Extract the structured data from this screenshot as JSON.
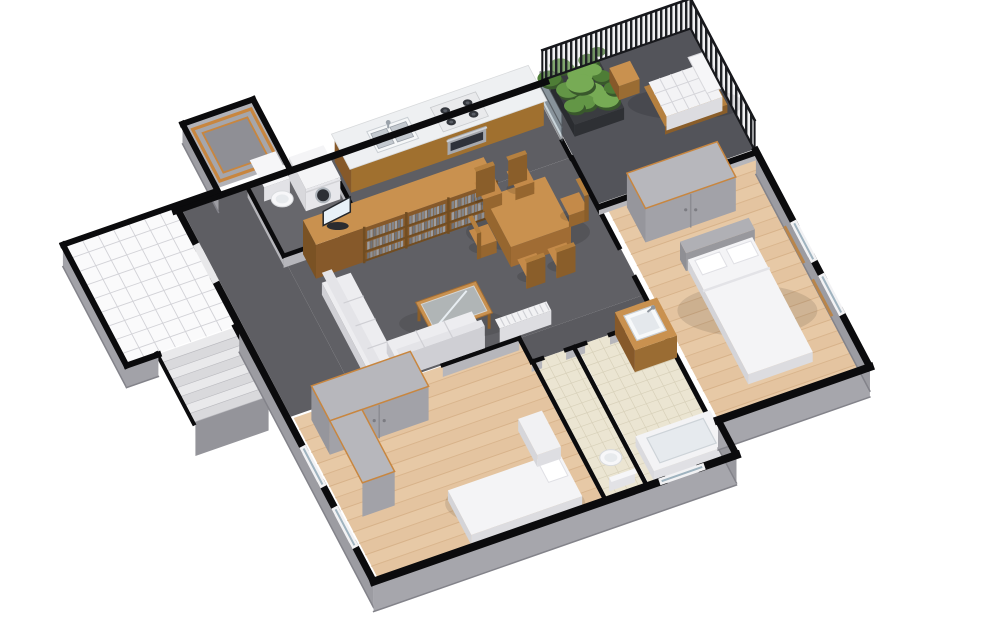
{
  "view": {
    "type": "3d-floorplan-cutaway-render",
    "background": "#ffffff",
    "width": 1000,
    "height": 644
  },
  "palette": {
    "wall_top": "#0b0b0d",
    "wall_face": "#a4a4aa",
    "wall_face_dark": "#94949a",
    "floor_dark": "#5e5e63",
    "floor_balcony": "#53545a",
    "floor_plank": "#e7c9a6",
    "plank_line": "#d3ac82",
    "tile_cream": "#ebe5d2",
    "tile_cream_line": "#d8d1ba",
    "tile_white": "#fafafb",
    "tile_white_line": "#d2d2d7",
    "wood_top": "#c9914f",
    "wood_face": "#9a6c33",
    "wood_face_dark": "#86592a",
    "accent_frame": "#c8863f",
    "white_soft": "#f4f4f6",
    "white_face": "#dcdce0",
    "glass": "#a9bac4",
    "books": [
      "#82858b",
      "#9a9da3",
      "#70737a",
      "#8d9096"
    ],
    "plant_greens": [
      "#4e7d36",
      "#639646",
      "#77ab55",
      "#39582c"
    ],
    "railing_dark": "#1f2125",
    "headboard_gray": "#b0b0b5",
    "cabinet_gray": "#b7b7bc",
    "cabinet_face": "#a2a2a8"
  },
  "scene": {
    "projection": {
      "tx": 178,
      "ty": 210,
      "ux": 43,
      "uy": -15,
      "vx": 20,
      "vy": 38
    },
    "rooms": [
      {
        "id": "stair-landing",
        "label": "stairwell landing",
        "rect": [
          -2.55,
          -0.12,
          0.28,
          3.02
        ],
        "floor": "tile-white"
      },
      {
        "id": "lift-room",
        "label": "lift shaft room",
        "rect": [
          0.98,
          -1.82,
          2.62,
          -0.18
        ],
        "floor": "plain",
        "fill": "#b2b2b7",
        "frame": true
      },
      {
        "id": "entry-hall",
        "label": "entry hall",
        "rect": [
          0.08,
          0.08,
          1.58,
          5.47
        ],
        "floor": "plain",
        "fill": "#5e5e63"
      },
      {
        "id": "utility-room",
        "label": "utility wc",
        "rect": [
          1.62,
          0.08,
          3.42,
          1.82
        ],
        "floor": "plain",
        "fill": "#67676c"
      },
      {
        "id": "kitchen",
        "label": "kitchen",
        "rect": [
          3.48,
          0.08,
          8.24,
          1.88
        ],
        "floor": "plain",
        "fill": "#5e5e63"
      },
      {
        "id": "living-dining",
        "label": "living dining room",
        "rect": [
          1.58,
          1.88,
          8.3,
          5.5
        ],
        "floor": "plain",
        "fill": "#606065"
      },
      {
        "id": "corridor",
        "label": "corridor",
        "rect": [
          5.35,
          5.5,
          8.3,
          6.12
        ],
        "floor": "plain",
        "fill": "#5a5a5f"
      },
      {
        "id": "balcony",
        "label": "balcony",
        "rect": [
          8.32,
          -0.06,
          11.95,
          3.12
        ],
        "floor": "plain",
        "fill": "#53545a"
      },
      {
        "id": "bedroom-right",
        "label": "bedroom",
        "rect": [
          8.45,
          3.3,
          11.93,
          8.83
        ],
        "floor": "planks"
      },
      {
        "id": "bathroom",
        "label": "bathroom",
        "rect": [
          6.42,
          6.12,
          8.3,
          9.76
        ],
        "floor": "tile-cream"
      },
      {
        "id": "wc",
        "label": "wc",
        "rect": [
          5.42,
          6.12,
          6.32,
          9.76
        ],
        "floor": "tile-cream"
      },
      {
        "id": "bedroom-left",
        "label": "bedroom",
        "rect": [
          0.12,
          5.52,
          5.35,
          9.76
        ],
        "floor": "planks"
      }
    ],
    "stairs": {
      "rect": [
        -1.85,
        3.05,
        -0.15,
        4.85
      ],
      "steps": 8
    },
    "furniture": [
      {
        "id": "toilet-utility",
        "type": "toilet",
        "at": [
          2.08,
          0.6
        ],
        "facing": "s"
      },
      {
        "id": "washing-machine",
        "type": "washer",
        "rect": [
          2.5,
          0.18,
          3.3,
          1.02
        ]
      },
      {
        "id": "kitchen-counter",
        "type": "counter",
        "rect": [
          3.58,
          0.14,
          8.06,
          0.96
        ]
      },
      {
        "id": "kitchen-sink",
        "type": "sink",
        "rect": [
          4.25,
          0.3,
          5.2,
          0.85
        ]
      },
      {
        "id": "cooktop",
        "type": "cooktop",
        "rect": [
          5.75,
          0.26,
          6.8,
          0.9
        ]
      },
      {
        "id": "oven",
        "type": "oven",
        "span": [
          5.82,
          6.72
        ]
      },
      {
        "id": "media-shelf-unit",
        "type": "shelf",
        "rect": [
          2.0,
          1.95,
          6.2,
          2.6
        ]
      },
      {
        "id": "tv",
        "type": "tv",
        "at": [
          2.62,
          2.27
        ]
      },
      {
        "id": "dining-table",
        "type": "table",
        "rect": [
          5.95,
          2.55,
          7.35,
          3.85
        ]
      },
      {
        "id": "dining-chair-1",
        "type": "chair",
        "at": [
          6.2,
          2.18
        ],
        "dir": "n"
      },
      {
        "id": "dining-chair-2",
        "type": "chair",
        "at": [
          6.95,
          2.18
        ],
        "dir": "n"
      },
      {
        "id": "dining-chair-3",
        "type": "chair",
        "at": [
          6.25,
          4.22
        ],
        "dir": "s"
      },
      {
        "id": "dining-chair-4",
        "type": "chair",
        "at": [
          6.95,
          4.22
        ],
        "dir": "s"
      },
      {
        "id": "dining-chair-5",
        "type": "chair",
        "at": [
          5.6,
          3.2
        ],
        "dir": "w"
      },
      {
        "id": "dining-chair-6",
        "type": "chair",
        "at": [
          7.72,
          3.2
        ],
        "dir": "e"
      },
      {
        "id": "coffee-table",
        "type": "coffee",
        "rect": [
          3.55,
          4.25,
          4.95,
          5.08
        ]
      },
      {
        "id": "sofa",
        "type": "sofa",
        "parts": [
          [
            1.95,
            3.0,
            2.62,
            5.45
          ],
          [
            2.62,
            4.8,
            4.6,
            5.45
          ]
        ]
      },
      {
        "id": "radiator",
        "type": "radiator",
        "rect": [
          4.95,
          5.2,
          6.15,
          5.44
        ]
      },
      {
        "id": "planter",
        "type": "planter",
        "rect": [
          8.55,
          0.25,
          9.7,
          1.45
        ]
      },
      {
        "id": "wood-cube-table",
        "type": "cube",
        "rect": [
          9.8,
          0.5,
          10.28,
          0.98
        ]
      },
      {
        "id": "sun-lounger",
        "type": "lounger",
        "rect": [
          10.35,
          1.05,
          11.8,
          2.1
        ]
      },
      {
        "id": "wardrobe-right",
        "type": "wardrobe",
        "rect": [
          8.85,
          3.42,
          10.95,
          4.35
        ]
      },
      {
        "id": "bed-right",
        "type": "bed",
        "rect": [
          9.35,
          5.0,
          10.95,
          8.3
        ],
        "head": "n"
      },
      {
        "id": "vanity-basin",
        "type": "vanity",
        "rect": [
          7.3,
          6.15,
          8.28,
          7.15
        ]
      },
      {
        "id": "bathtub",
        "type": "tub",
        "rect": [
          6.55,
          8.8,
          8.28,
          9.72
        ]
      },
      {
        "id": "toilet-wc",
        "type": "toilet",
        "at": [
          5.86,
          9.18
        ],
        "facing": "n"
      },
      {
        "id": "wardrobe-left-a",
        "type": "wardrobe",
        "rect": [
          0.45,
          5.7,
          2.75,
          6.62
        ]
      },
      {
        "id": "wardrobe-left-b",
        "type": "wardrobe",
        "rect": [
          0.45,
          6.62,
          1.2,
          8.25
        ],
        "dir": "v"
      },
      {
        "id": "bed-left",
        "type": "bed",
        "rect": [
          2.3,
          8.55,
          4.88,
          9.72
        ],
        "head": "e"
      },
      {
        "id": "desk-left",
        "type": "desk",
        "rect": [
          4.4,
          7.55,
          4.95,
          8.5
        ]
      }
    ],
    "walls_interior": [
      {
        "a": [
          1.6,
          0.04
        ],
        "b": [
          1.6,
          1.84
        ],
        "w": 4.5,
        "face": 10
      },
      {
        "a": [
          3.46,
          0.04
        ],
        "b": [
          3.46,
          1.84
        ],
        "w": 4.5,
        "face": 10
      },
      {
        "a": [
          1.6,
          1.84
        ],
        "b": [
          2.2,
          1.84
        ],
        "w": 4.5,
        "face": 12
      },
      {
        "a": [
          2.95,
          1.84
        ],
        "b": [
          3.46,
          1.84
        ],
        "w": 4.5,
        "face": 12
      },
      {
        "a": [
          8.26,
          0.02
        ],
        "b": [
          8.26,
          0.35
        ],
        "w": 4.5,
        "face": 0
      },
      {
        "a": [
          8.26,
          1.45
        ],
        "b": [
          8.26,
          1.9
        ],
        "w": 4.5,
        "face": 0
      },
      {
        "a": [
          8.28,
          1.9
        ],
        "b": [
          8.28,
          4.25
        ],
        "w": 5,
        "face": 0
      },
      {
        "a": [
          8.28,
          5.05
        ],
        "b": [
          8.28,
          8.85
        ],
        "w": 5,
        "face": 0
      },
      {
        "a": [
          8.3,
          3.2
        ],
        "b": [
          11.95,
          3.2
        ],
        "w": 6,
        "face": 8
      },
      {
        "a": [
          1.6,
          5.5
        ],
        "b": [
          2.85,
          5.5
        ],
        "w": 4.5,
        "face": 12
      },
      {
        "a": [
          3.6,
          5.5
        ],
        "b": [
          5.38,
          5.5
        ],
        "w": 4.5,
        "face": 12
      },
      {
        "a": [
          5.38,
          5.5
        ],
        "b": [
          5.38,
          6.12
        ],
        "w": 4.5,
        "face": 0
      },
      {
        "a": [
          5.38,
          6.12
        ],
        "b": [
          5.62,
          6.12
        ],
        "w": 4.5,
        "face": 10
      },
      {
        "a": [
          6.18,
          6.12
        ],
        "b": [
          6.62,
          6.12
        ],
        "w": 4.5,
        "face": 10
      },
      {
        "a": [
          7.2,
          6.12
        ],
        "b": [
          8.28,
          6.12
        ],
        "w": 4.5,
        "face": 10
      },
      {
        "a": [
          6.36,
          6.12
        ],
        "b": [
          6.36,
          9.74
        ],
        "w": 4.5,
        "face": 0
      },
      {
        "a": [
          5.4,
          6.12
        ],
        "b": [
          5.4,
          9.74
        ],
        "w": 4.5,
        "face": 0
      }
    ],
    "glass_door": {
      "a": [
        8.26,
        0.35
      ],
      "b": [
        8.26,
        1.45
      ],
      "h": 28
    },
    "railings": [
      {
        "a": [
          8.5,
          -0.06
        ],
        "b": [
          11.95,
          -0.06
        ],
        "h": 30
      },
      {
        "a": [
          11.95,
          -0.06
        ],
        "b": [
          11.95,
          3.14
        ],
        "h": 30
      }
    ],
    "walls_exterior_faces": [
      {
        "a": [
          0.98,
          -1.88
        ],
        "b": [
          0.98,
          -0.08
        ],
        "h": 20,
        "c": "#9d9da3"
      },
      {
        "a": [
          -2.62,
          -0.12
        ],
        "b": [
          -2.62,
          3.06
        ],
        "h": 22,
        "c": "#a2a2a8"
      },
      {
        "a": [
          -2.62,
          3.06
        ],
        "b": [
          -1.88,
          3.06
        ],
        "h": 22,
        "c": "#a2a2a8"
      },
      {
        "a": [
          0,
          3.06
        ],
        "b": [
          0,
          9.78
        ],
        "h": 26,
        "c": "#9c9ca2"
      },
      {
        "a": [
          0,
          9.78
        ],
        "b": [
          8.44,
          9.78
        ],
        "h": 30,
        "c": "#a6a6ac"
      },
      {
        "a": [
          8.44,
          9.78
        ],
        "b": [
          8.44,
          8.86
        ],
        "h": 28,
        "c": "#98989e"
      },
      {
        "a": [
          8.44,
          8.86
        ],
        "b": [
          11.97,
          8.86
        ],
        "h": 30,
        "c": "#a6a6ac"
      },
      {
        "a": [
          11.97,
          8.86
        ],
        "b": [
          11.97,
          3.16
        ],
        "h": 24,
        "c": "#9c9ca2"
      }
    ],
    "walls_exterior": [
      {
        "a": [
          -0.06,
          0
        ],
        "b": [
          8.55,
          0
        ],
        "w": 7
      },
      {
        "a": [
          0.98,
          -1.88
        ],
        "b": [
          2.62,
          -1.88
        ],
        "w": 6
      },
      {
        "a": [
          0.98,
          -1.88
        ],
        "b": [
          0.98,
          -0.08
        ],
        "w": 6
      },
      {
        "a": [
          2.62,
          -1.88
        ],
        "b": [
          2.62,
          -0.08
        ],
        "w": 6
      },
      {
        "a": [
          -2.62,
          -0.12
        ],
        "b": [
          0.95,
          -0.12
        ],
        "w": 6
      },
      {
        "a": [
          -2.62,
          -0.12
        ],
        "b": [
          -2.62,
          3.06
        ],
        "w": 6
      },
      {
        "a": [
          -2.62,
          3.06
        ],
        "b": [
          -1.88,
          3.06
        ],
        "w": 6
      },
      {
        "a": [
          0,
          -0.06
        ],
        "b": [
          0,
          0.98
        ],
        "w": 7
      },
      {
        "a": [
          0,
          1.82
        ],
        "b": [
          0,
          6.3
        ],
        "w": 7
      },
      {
        "a": [
          0,
          7.2
        ],
        "b": [
          0,
          7.9
        ],
        "w": 7
      },
      {
        "a": [
          0,
          8.8
        ],
        "b": [
          0,
          9.78
        ],
        "w": 7
      },
      {
        "a": [
          0,
          9.78
        ],
        "b": [
          6.72,
          9.78
        ],
        "w": 8
      },
      {
        "a": [
          7.62,
          9.78
        ],
        "b": [
          8.44,
          9.78
        ],
        "w": 8
      },
      {
        "a": [
          8.44,
          9.78
        ],
        "b": [
          8.44,
          8.86
        ],
        "w": 7
      },
      {
        "a": [
          8.44,
          8.86
        ],
        "b": [
          11.97,
          8.86
        ],
        "w": 8
      },
      {
        "a": [
          11.97,
          8.86
        ],
        "b": [
          11.97,
          7.4
        ],
        "w": 7
      },
      {
        "a": [
          11.97,
          6.5
        ],
        "b": [
          11.97,
          6.0
        ],
        "w": 7
      },
      {
        "a": [
          11.97,
          5.1
        ],
        "b": [
          11.97,
          3.16
        ],
        "w": 7
      }
    ],
    "windows": [
      {
        "id": "entry-door-gap",
        "a": [
          0,
          0.98
        ],
        "b": [
          0,
          1.82
        ],
        "type": "door"
      },
      {
        "id": "window-bedroom-left-1",
        "a": [
          0,
          6.3
        ],
        "b": [
          0,
          7.2
        ],
        "type": "win"
      },
      {
        "id": "window-bedroom-left-2",
        "a": [
          0,
          7.9
        ],
        "b": [
          0,
          8.8
        ],
        "type": "win"
      },
      {
        "id": "window-bathroom",
        "a": [
          6.72,
          9.78
        ],
        "b": [
          7.62,
          9.78
        ],
        "type": "win"
      },
      {
        "id": "window-bedroom-right-1",
        "a": [
          11.97,
          5.1
        ],
        "b": [
          11.97,
          6.0
        ],
        "type": "win-sill"
      },
      {
        "id": "window-bedroom-right-2",
        "a": [
          11.97,
          6.5
        ],
        "b": [
          11.97,
          7.4
        ],
        "type": "win-sill"
      }
    ]
  }
}
